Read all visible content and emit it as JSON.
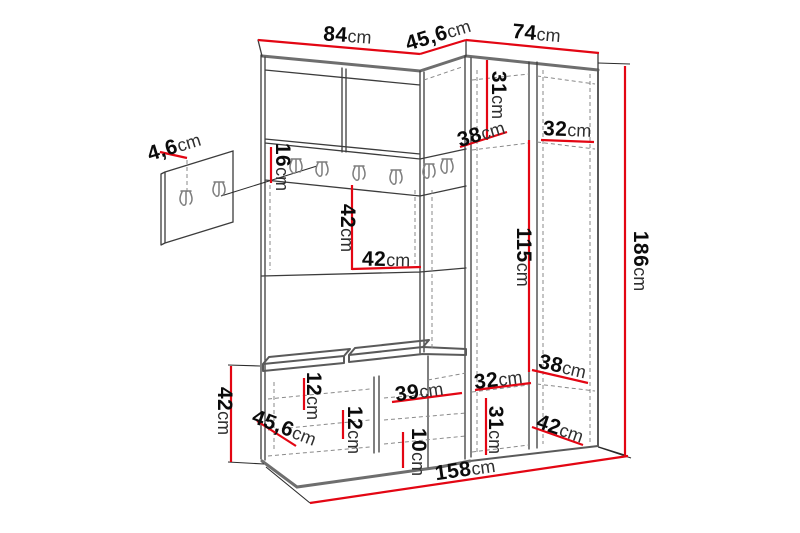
{
  "diagram": {
    "subject": "corner hallway wardrobe set with bench, hook rail and separate wall hook panel",
    "background_color": "#ffffff",
    "dimension_line_color": "#e30613",
    "drawing_line_color": "#3c3c3c",
    "unit": "cm",
    "hook_rail_hooks": 6,
    "wall_panel_hooks": 2
  },
  "dimensions": {
    "top_main_width": {
      "value": "84",
      "unit": "cm"
    },
    "top_corner_depth": {
      "value": "45,6",
      "unit": "cm"
    },
    "top_right_width": {
      "value": "74",
      "unit": "cm"
    },
    "wall_panel_thickness": {
      "value": "4,6",
      "unit": "cm"
    },
    "hook_rail_height": {
      "value": "16",
      "unit": "cm"
    },
    "upper_shelf_height": {
      "value": "31",
      "unit": "cm"
    },
    "upper_shelf_depth": {
      "value": "38",
      "unit": "cm"
    },
    "upper_right_shelf_width": {
      "value": "32",
      "unit": "cm"
    },
    "niche_height": {
      "value": "42",
      "unit": "cm"
    },
    "niche_width": {
      "value": "42",
      "unit": "cm"
    },
    "hanging_space_height": {
      "value": "115",
      "unit": "cm"
    },
    "total_height": {
      "value": "186",
      "unit": "cm"
    },
    "lower_shelf_depth": {
      "value": "38",
      "unit": "cm"
    },
    "lower_left_shelf_width": {
      "value": "32",
      "unit": "cm"
    },
    "lower_compartment_height": {
      "value": "31",
      "unit": "cm"
    },
    "lower_right_shelf_width": {
      "value": "42",
      "unit": "cm"
    },
    "bench_compartment_width": {
      "value": "39",
      "unit": "cm"
    },
    "bench_compartment_height": {
      "value": "10",
      "unit": "cm"
    },
    "bench_cushion_height_left": {
      "value": "12",
      "unit": "cm"
    },
    "bench_cushion_height_mid": {
      "value": "12",
      "unit": "cm"
    },
    "bench_depth": {
      "value": "45,6",
      "unit": "cm"
    },
    "bench_height": {
      "value": "42",
      "unit": "cm"
    },
    "total_width": {
      "value": "158",
      "unit": "cm"
    }
  }
}
